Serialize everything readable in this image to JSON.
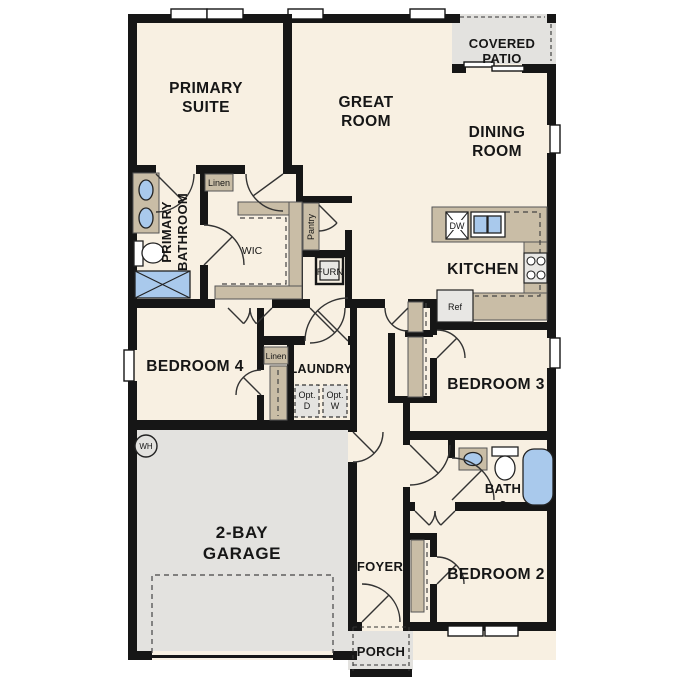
{
  "title": "Single story floor plan",
  "colors": {
    "floor": "#f8f0e2",
    "hard_surface": "#e3e2df",
    "casework_tan": "#c9bda6",
    "plumbing_blue": "#a9c9ec",
    "wall_black": "#161616"
  },
  "labels": {
    "primary_suite": [
      "PRIMARY",
      "SUITE"
    ],
    "great_room": [
      "GREAT",
      "ROOM"
    ],
    "covered_patio": [
      "COVERED",
      "PATIO"
    ],
    "dining_room": [
      "DINING",
      "ROOM"
    ],
    "kitchen": "KITCHEN",
    "primary_bathroom": [
      "PRIMARY",
      "BATHROOM"
    ],
    "wic": "WIC",
    "linen_primary": "Linen",
    "pantry": "Pantry",
    "furnace": "FURN",
    "dishwasher": "DW",
    "refrigerator": "Ref",
    "bedroom4": "BEDROOM 4",
    "linen_hall": "Linen",
    "laundry": "LAUNDRY",
    "opt_dryer": [
      "Opt.",
      "D"
    ],
    "opt_washer": [
      "Opt.",
      "W"
    ],
    "water_heater": "WH",
    "garage": [
      "2-BAY",
      "GARAGE"
    ],
    "bedroom3": "BEDROOM 3",
    "bath2": [
      "BATH",
      "2"
    ],
    "bedroom2": "BEDROOM 2",
    "foyer": "FOYER",
    "porch": "PORCH"
  }
}
